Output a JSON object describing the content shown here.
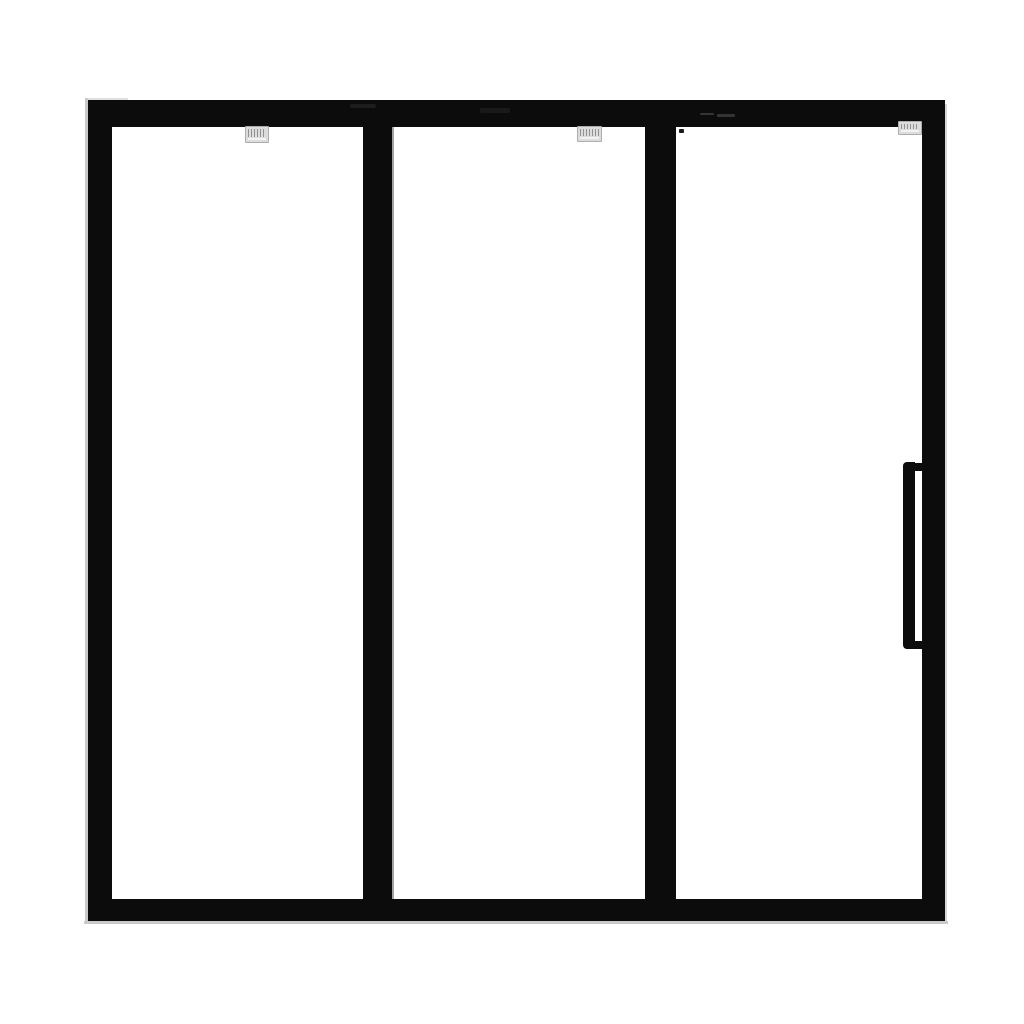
{
  "scene": {
    "type": "product-photograph",
    "subject": "Three-panel glass partition door with black frame and ladder pull handle",
    "panel_count": 3,
    "text_visible": "none (sticker print is illegible)"
  },
  "colors": {
    "background": "#ffffff",
    "frame": "#0c0c0c",
    "glass": "#ffffff",
    "edge-highlight": "#c9c9c9",
    "sticker": "#dcdcdc",
    "sticker-ink": "#7f7f7f",
    "speck": "#1c1c1c",
    "sheen": "#343434"
  },
  "panels": [
    {
      "name": "left-glass-panel",
      "sticker": "small illegible label at top"
    },
    {
      "name": "center-glass-panel",
      "sticker": "small illegible label at top"
    },
    {
      "name": "right-glass-panel",
      "sticker": "small illegible label at top",
      "speck": "tiny dark speck near top-left of glass",
      "has_handle": true
    }
  ],
  "handle": {
    "style": "ladder-pull",
    "position": "right stile, vertically centered",
    "color": "#0c0c0c"
  }
}
